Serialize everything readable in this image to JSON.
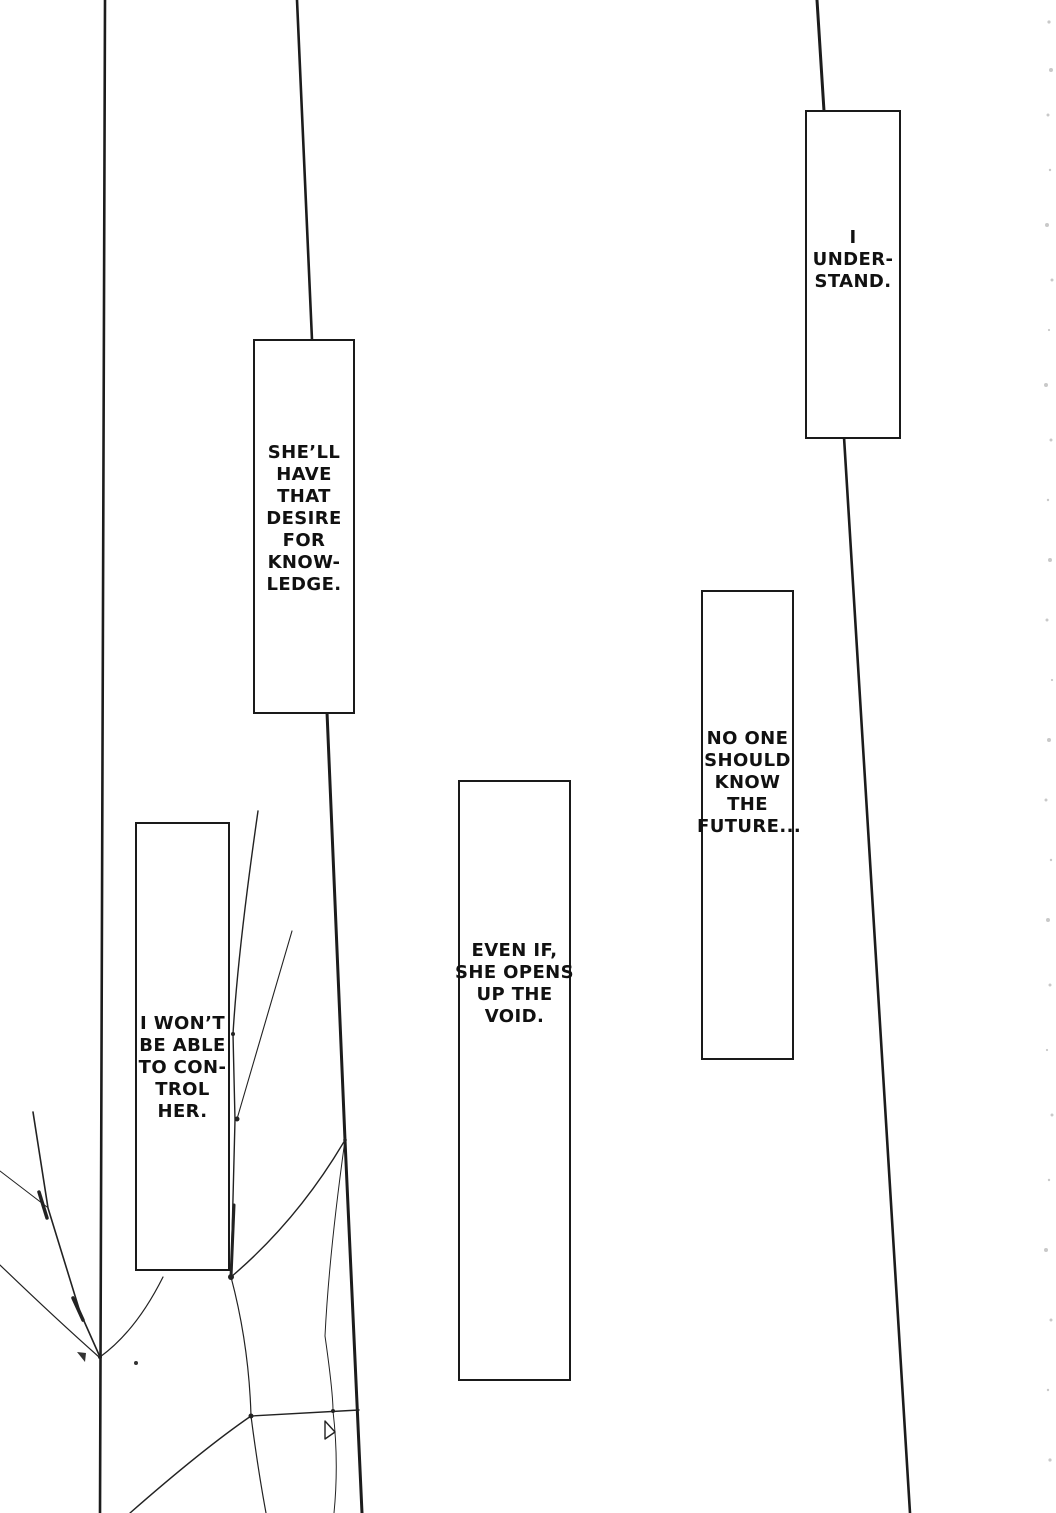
{
  "colors": {
    "ink": "#1a1a1a",
    "paper": "#ffffff"
  },
  "speech_boxes": [
    {
      "id": "i-understand",
      "text": "I\nUNDER-\nSTAND."
    },
    {
      "id": "desire-knowledge",
      "text": "SHE’LL\nHAVE\nTHAT\nDESIRE\nFOR\nKNOW-\nLEDGE."
    },
    {
      "id": "no-one-future",
      "text": "NO ONE\nSHOULD\nKNOW\nTHE\nFUTURE..."
    },
    {
      "id": "cant-control",
      "text": "I WON’T\nBE ABLE\nTO CON-\nTROL\nHER."
    },
    {
      "id": "even-if-void",
      "text": "EVEN IF,\nSHE OPENS\nUP THE\nVOID."
    }
  ]
}
